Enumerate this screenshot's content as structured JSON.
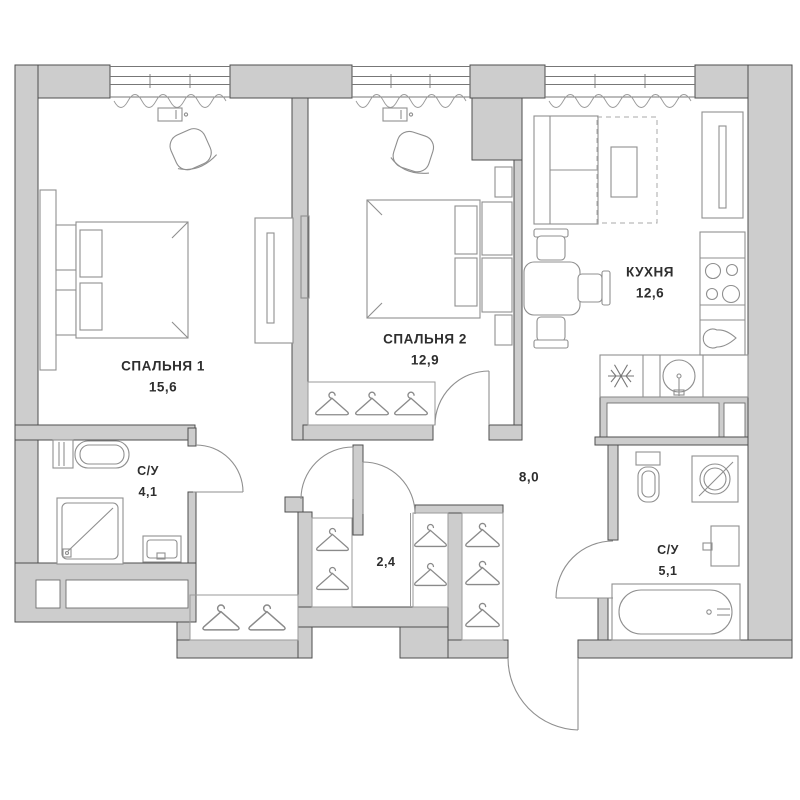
{
  "rooms": [
    {
      "id": "bedroom-1",
      "label": "СПАЛЬНЯ 1",
      "area": "15,6"
    },
    {
      "id": "bedroom-2",
      "label": "СПАЛЬНЯ 2",
      "area": "12,9"
    },
    {
      "id": "kitchen",
      "label": "КУХНЯ",
      "area": "12,6"
    },
    {
      "id": "bathroom-1",
      "label": "С/У",
      "area": "4,1"
    },
    {
      "id": "bathroom-2",
      "label": "С/У",
      "area": "5,1"
    },
    {
      "id": "closet",
      "label": "",
      "area": "2,4"
    },
    {
      "id": "hallway",
      "label": "",
      "area": "8,0"
    }
  ],
  "icons": {
    "hanger": "clothes-hanger",
    "snowflake": "refrigerator",
    "burners": "stove-hob",
    "drop": "kitchen-sink"
  },
  "colors": {
    "wall_fill": "#cdcdcd",
    "wall_stroke": "#4e4e4e",
    "furniture_stroke": "#8f8f8f",
    "label_text": "#2e2e2e",
    "background": "#ffffff"
  }
}
